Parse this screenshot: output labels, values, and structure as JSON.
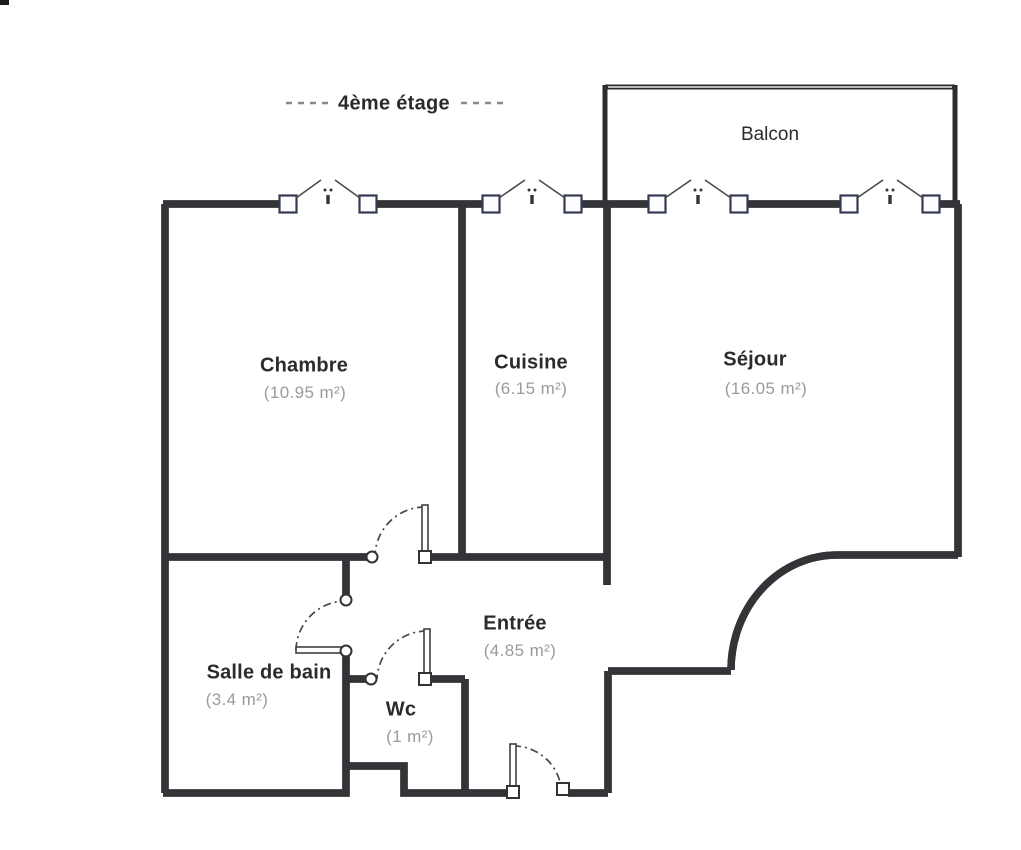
{
  "title": {
    "text": "4ème étage"
  },
  "balcony": {
    "label": "Balcon"
  },
  "rooms": {
    "chambre": {
      "name": "Chambre",
      "area": "(10.95 m²)"
    },
    "cuisine": {
      "name": "Cuisine",
      "area": "(6.15 m²)"
    },
    "sejour": {
      "name": "Séjour",
      "area": "(16.05 m²)"
    },
    "entree": {
      "name": "Entrée",
      "area": "(4.85 m²)"
    },
    "salle_de_bain": {
      "name": "Salle de bain",
      "area": "(3.4 m²)"
    },
    "wc": {
      "name": "Wc",
      "area": "(1 m²)"
    }
  },
  "symbols": {
    "window": "casement-window-icon",
    "door": "door-swing-icon"
  },
  "colors": {
    "wall": "#333438",
    "wall_inner": "#e8e7e3",
    "window_frame": "#343a52",
    "room_name_text": "#2b2b2b",
    "area_text": "#9b9b9b",
    "dash_accent": "#8a8a8a",
    "background": "#ffffff"
  }
}
